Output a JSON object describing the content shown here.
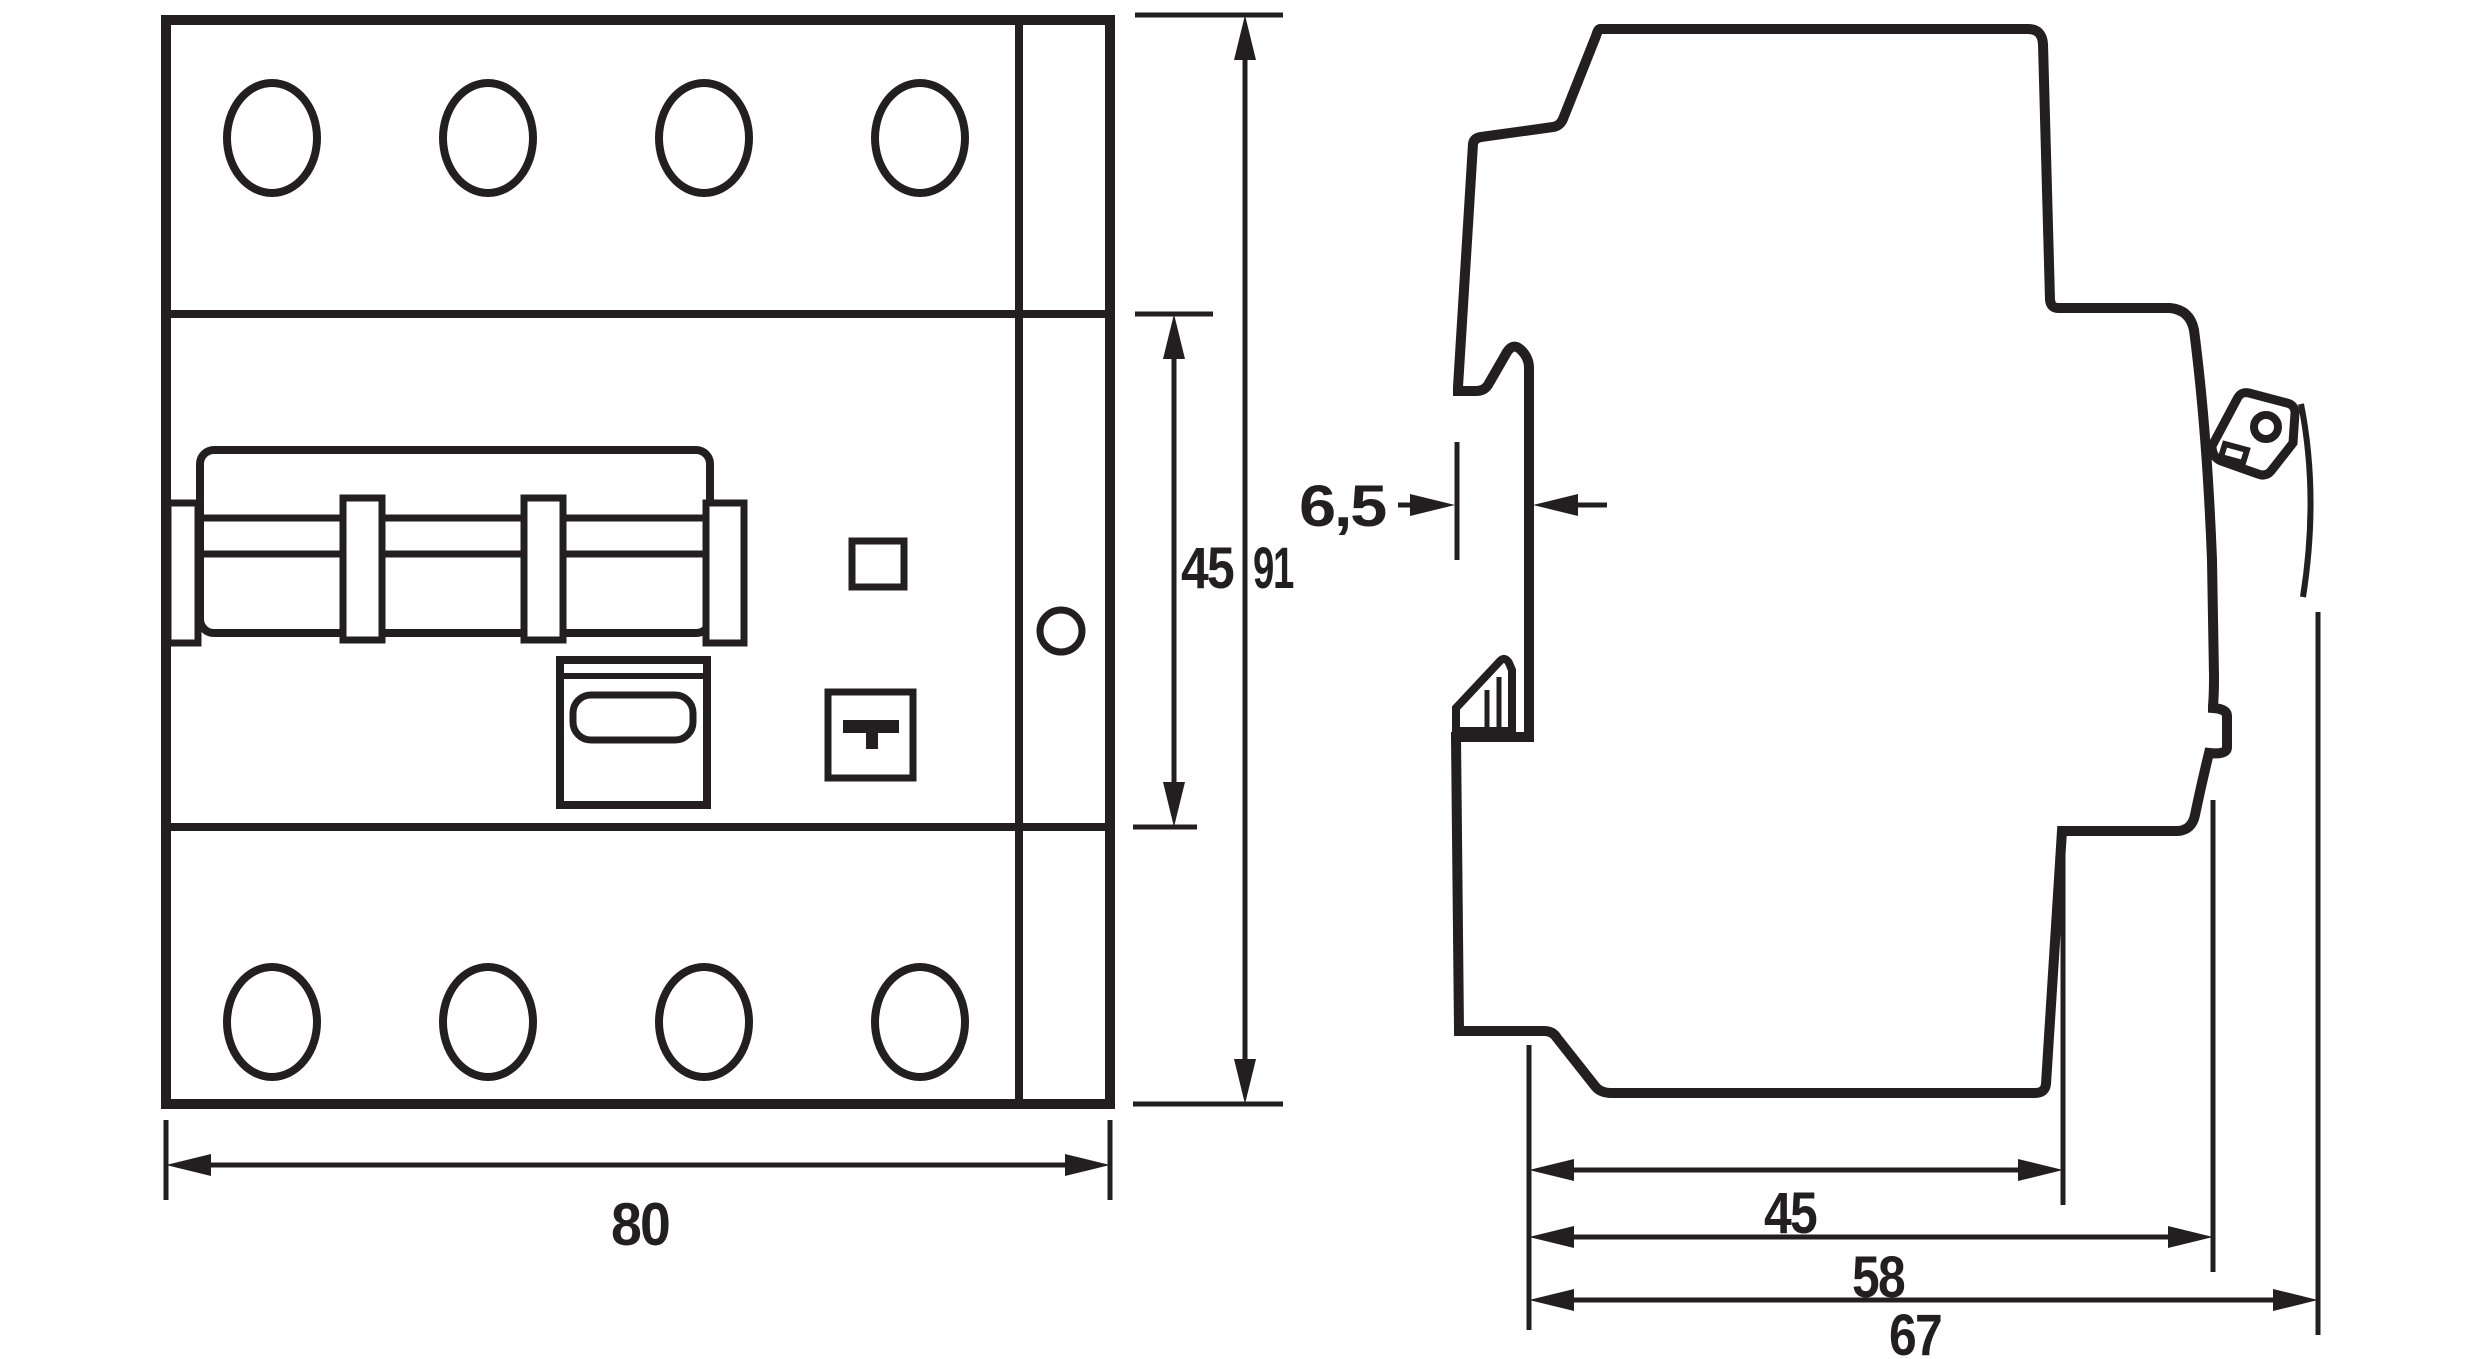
{
  "page": {
    "background": "#ffffff",
    "line_color": "#231f20",
    "description": "Technical dimension drawing of a 4-pole DIN-rail residual current circuit breaker: front view and side profile view"
  },
  "front_view": {
    "dim_width": "80",
    "dim_section_height": "45",
    "dim_total_height": "91",
    "test_button_glyph": "T",
    "terminal_count_top": 4,
    "terminal_count_bottom": 4
  },
  "side_view": {
    "dim_rail_hook_depth": "6,5",
    "dim_depth_front": "45",
    "dim_depth_mid": "58",
    "dim_depth_total": "67"
  }
}
